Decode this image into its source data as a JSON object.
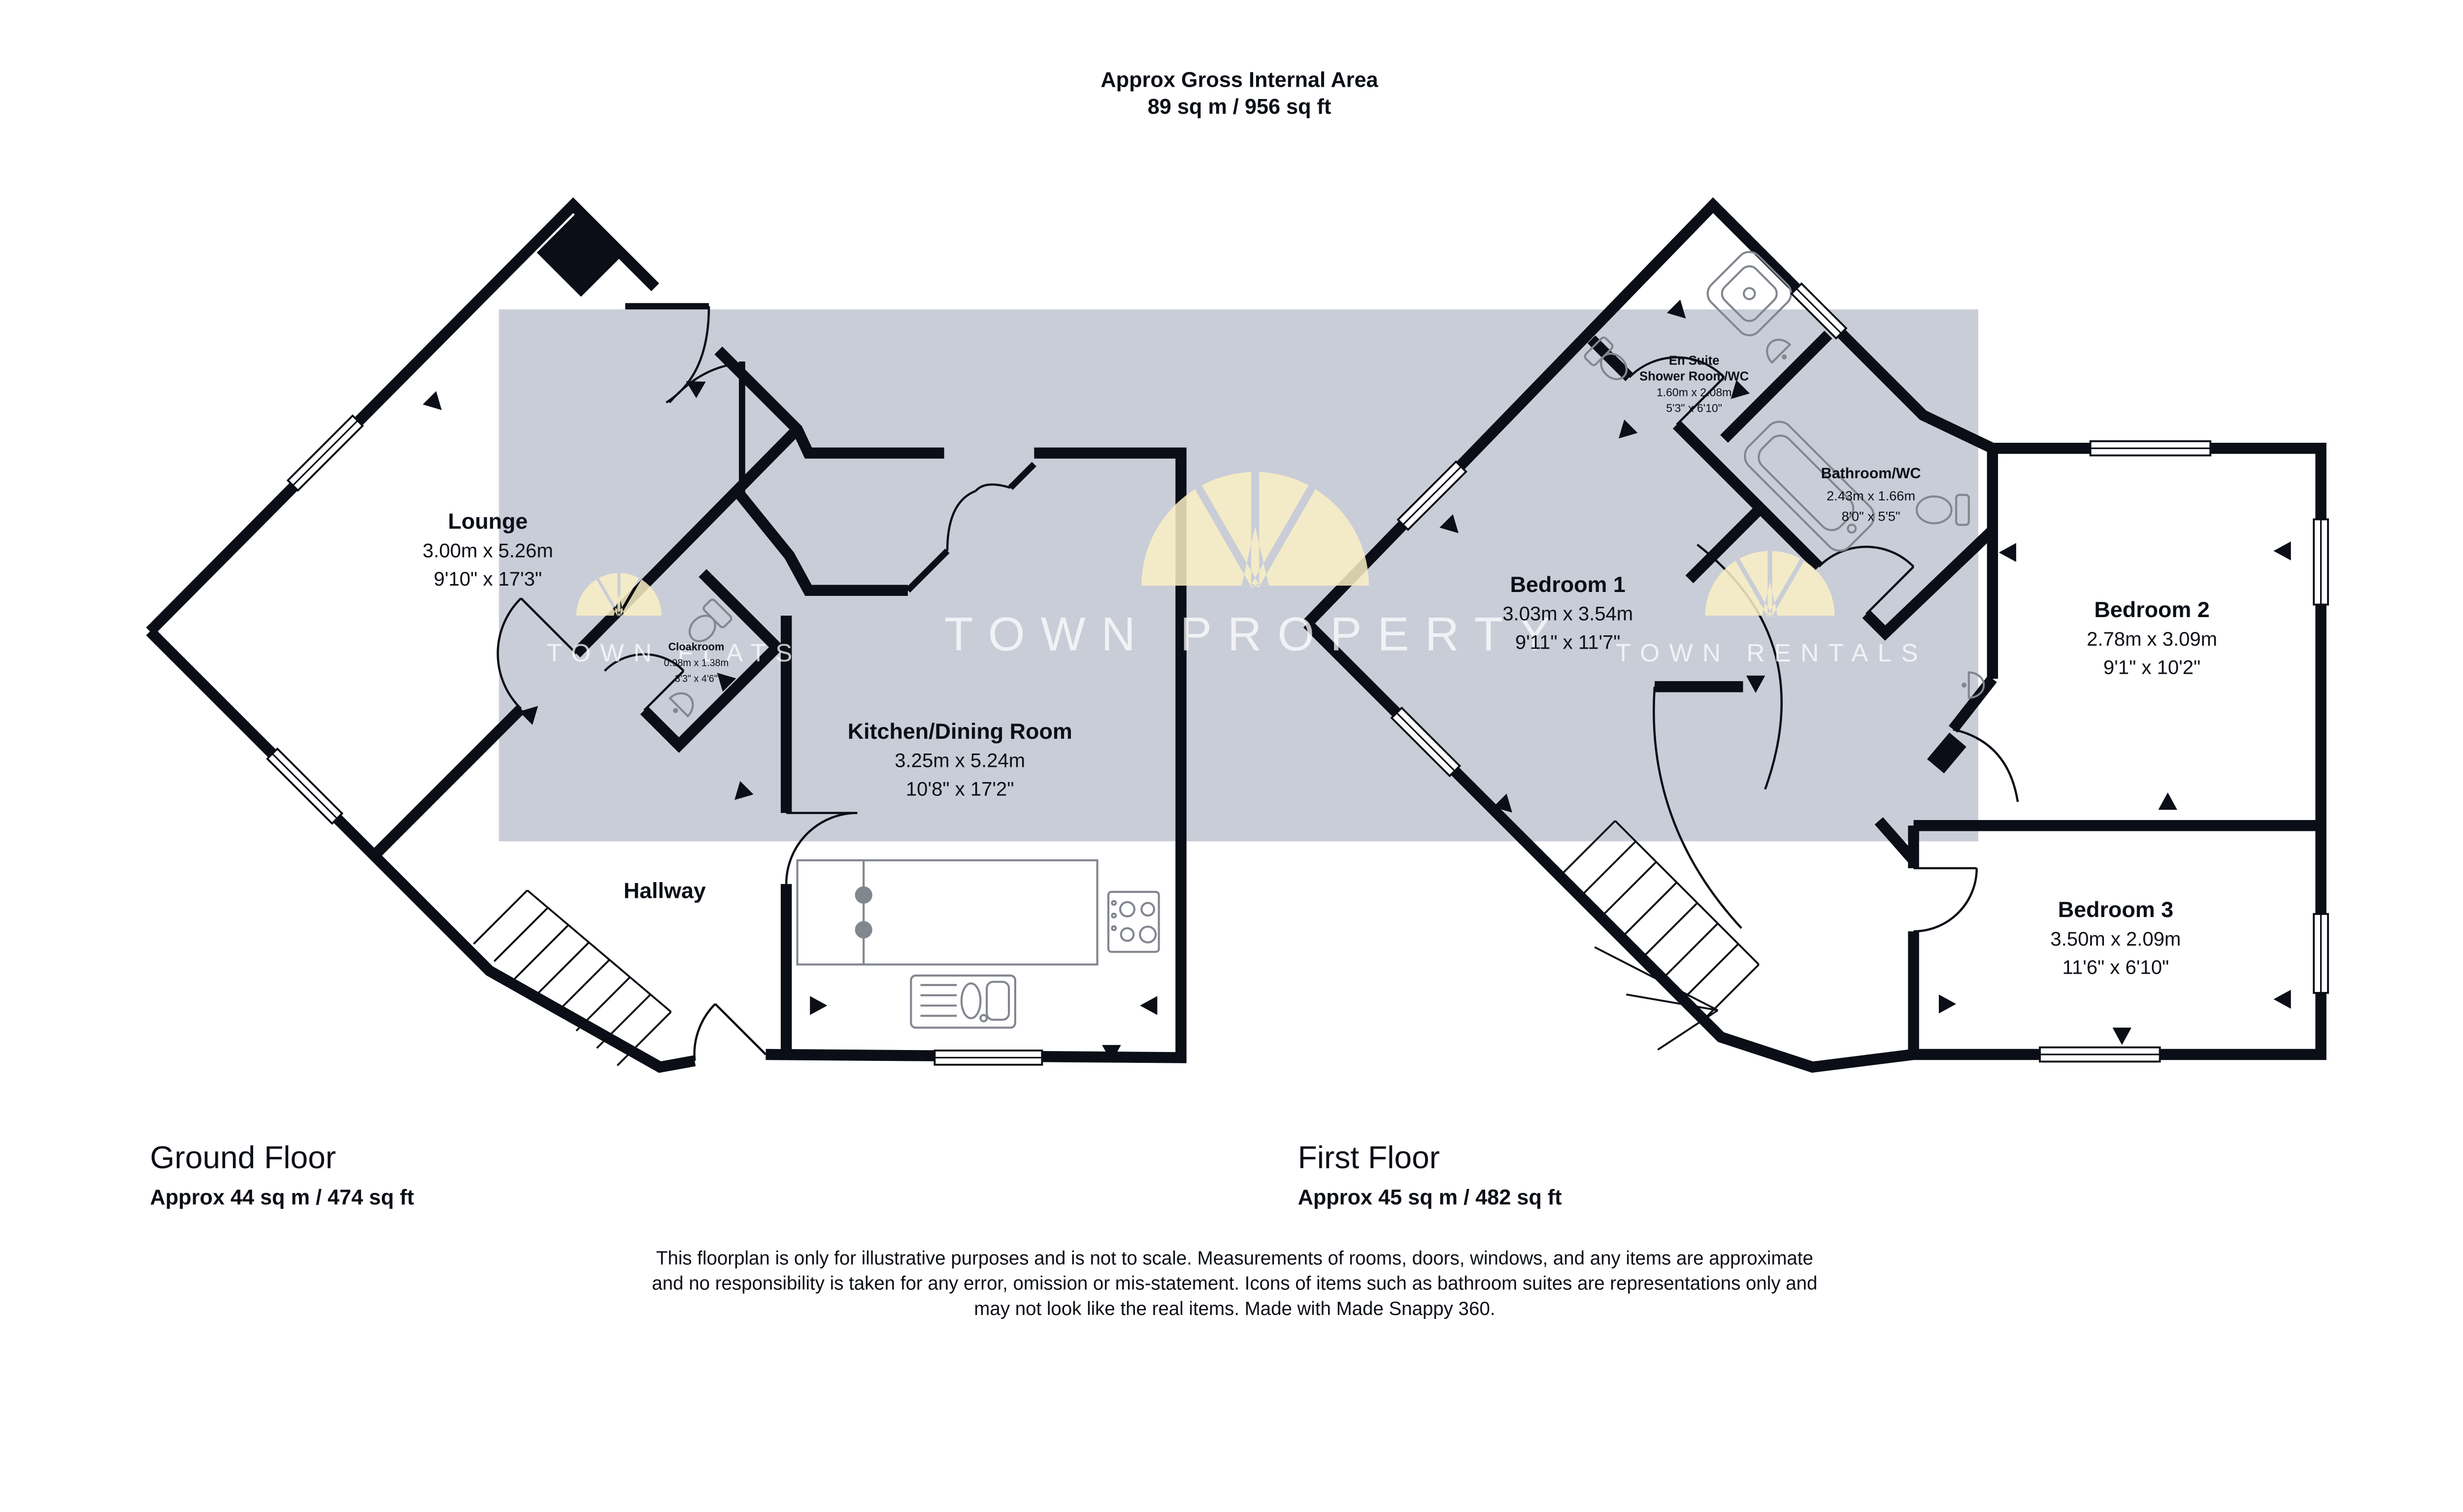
{
  "title": {
    "line1": "Approx Gross Internal Area",
    "line2": "89 sq m / 956 sq ft"
  },
  "watermarks": {
    "left": "TOWN FLATS",
    "center": "TOWN PROPERTY",
    "right": "TOWN RENTALS"
  },
  "colors": {
    "wall": "#0b0e16",
    "band": "#c9cdd7",
    "logo_yellow": "#faf0c4",
    "watermark_text": "#ffffff"
  },
  "ground_floor": {
    "label": "Ground Floor",
    "area": "Approx 44 sq m / 474 sq ft",
    "lounge": {
      "name": "Lounge",
      "metric": "3.00m x 5.26m",
      "imperial": "9'10\" x 17'3\""
    },
    "cloakroom": {
      "name": "Cloakroom",
      "metric": "0.98m x 1.38m",
      "imperial": "3'3\" x 4'6\""
    },
    "kitchen": {
      "name": "Kitchen/Dining Room",
      "metric": "3.25m x 5.24m",
      "imperial": "10'8\" x 17'2\""
    },
    "hallway": {
      "name": "Hallway"
    }
  },
  "first_floor": {
    "label": "First Floor",
    "area": "Approx 45 sq m / 482 sq ft",
    "bedroom1": {
      "name": "Bedroom 1",
      "metric": "3.03m x 3.54m",
      "imperial": "9'11\" x 11'7\""
    },
    "ensuite": {
      "name1": "En Suite",
      "name2": "Shower Room/WC",
      "metric": "1.60m x 2.08m",
      "imperial": "5'3\" x 6'10\""
    },
    "bathroom": {
      "name": "Bathroom/WC",
      "metric": "2.43m x 1.66m",
      "imperial": "8'0\" x 5'5\""
    },
    "bedroom2": {
      "name": "Bedroom 2",
      "metric": "2.78m x 3.09m",
      "imperial": "9'1\" x 10'2\""
    },
    "bedroom3": {
      "name": "Bedroom 3",
      "metric": "3.50m x 2.09m",
      "imperial": "11'6\" x 6'10\""
    }
  },
  "disclaimer": {
    "line1": "This floorplan is only for illustrative purposes and is not to scale. Measurements of rooms, doors, windows, and any items are approximate",
    "line2": "and no responsibility is taken for any error, omission or mis-statement. Icons of items such as bathroom suites are representations only and",
    "line3": "may not look like the real items. Made with Made Snappy 360."
  }
}
